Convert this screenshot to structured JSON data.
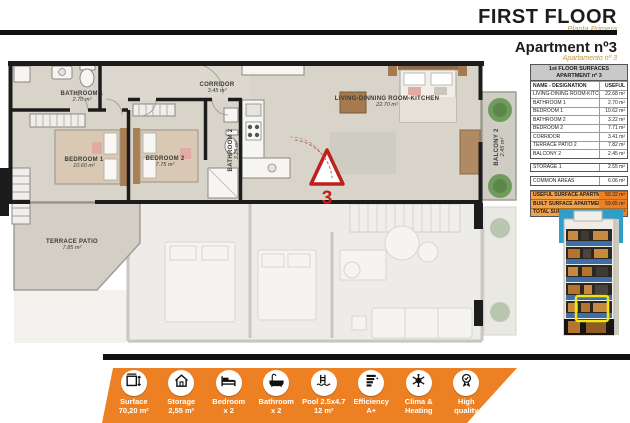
{
  "header": {
    "title": "FIRST FLOOR",
    "subtitle": "Planta Primera",
    "apartment_title": "Apartment nº3",
    "apartment_subtitle": "Apartamento nº 3"
  },
  "surfaces_table": {
    "title_line1": "1st FLOOR SURFACES",
    "title_line2": "APARTMENT nº 3",
    "col_name": "NAME - DESIGNATION",
    "col_value": "USEFUL",
    "rows": [
      {
        "name": "LIVING-DINING ROOM-KITCHEN",
        "value": "22.68 m²"
      },
      {
        "name": "BATHROOM 1",
        "value": "2.70 m²"
      },
      {
        "name": "BEDROOM 1",
        "value": "10.62 m²"
      },
      {
        "name": "BATHROOM 2",
        "value": "3.22 m²"
      },
      {
        "name": "BEDROOM 2",
        "value": "7.71 m²"
      },
      {
        "name": "CORRIDOR",
        "value": "3.41 m²"
      },
      {
        "name": "TERRACE PATIO 2",
        "value": "7.82 m²"
      },
      {
        "name": "BALCONY 2",
        "value": "2.45 m²"
      }
    ],
    "storage_row": {
      "name": "STORAGE 1",
      "value": "2.55 m²"
    },
    "common_row": {
      "name": "COMMON AREAS",
      "value": "6.06 m²"
    },
    "totals": [
      {
        "name": "USEFUL SURFACE APARTMENT",
        "value": "50.32 m²"
      },
      {
        "name": "BUILT SURFACE APARTMENT",
        "value": "59.65 m²"
      },
      {
        "name": "TOTAL SURFACE",
        "value": "80.26 m²"
      }
    ]
  },
  "floor_plan": {
    "marker_number": "3",
    "rooms": [
      {
        "id": "bathroom1",
        "label": "BATHROOM 1",
        "area": "2.70 m²"
      },
      {
        "id": "bedroom1",
        "label": "BEDROOM 1",
        "area": "10.60 m²"
      },
      {
        "id": "corridor",
        "label": "CORRIDOR",
        "area": "3.45 m²"
      },
      {
        "id": "bathroom2",
        "label": "BATHROOM 2",
        "area": "3.25 m²"
      },
      {
        "id": "bedroom2",
        "label": "BEDROOM 2",
        "area": "7.75 m²"
      },
      {
        "id": "living",
        "label": "LIVING-DINNING ROOM-KITCHEN",
        "area": "22.70 m²"
      },
      {
        "id": "terrace",
        "label": "TERRACE PATIO",
        "area": "7.85 m²"
      },
      {
        "id": "balcony",
        "label": "BALCONY 2",
        "area": "2.45 m²"
      }
    ]
  },
  "features": [
    {
      "icon": "dimensions-icon",
      "line1": "Surface",
      "line2": "70,20 m²"
    },
    {
      "icon": "house-icon",
      "line1": "Storage",
      "line2": "2,55 m²"
    },
    {
      "icon": "bed-icon",
      "line1": "Bedroom",
      "line2": "x 2"
    },
    {
      "icon": "bathtub-icon",
      "line1": "Bathroom",
      "line2": "x 2"
    },
    {
      "icon": "pool-icon",
      "line1": "Pool 2.5x4.7",
      "line2": "12 m²"
    },
    {
      "icon": "efficiency-icon",
      "line1": "Efficiency",
      "line2": "A+"
    },
    {
      "icon": "climate-icon",
      "line1": "Clima &",
      "line2": "Heating"
    },
    {
      "icon": "quality-icon",
      "line1": "High",
      "line2": "quality"
    }
  ],
  "colors": {
    "accent_orange": "#ED8022",
    "table_orange": "#F2A24B",
    "gold": "#C19A3F",
    "wall_black": "#1C1C1C",
    "plan_floor": "#D8D4CA",
    "highlight_yellow": "#F2E40E"
  }
}
